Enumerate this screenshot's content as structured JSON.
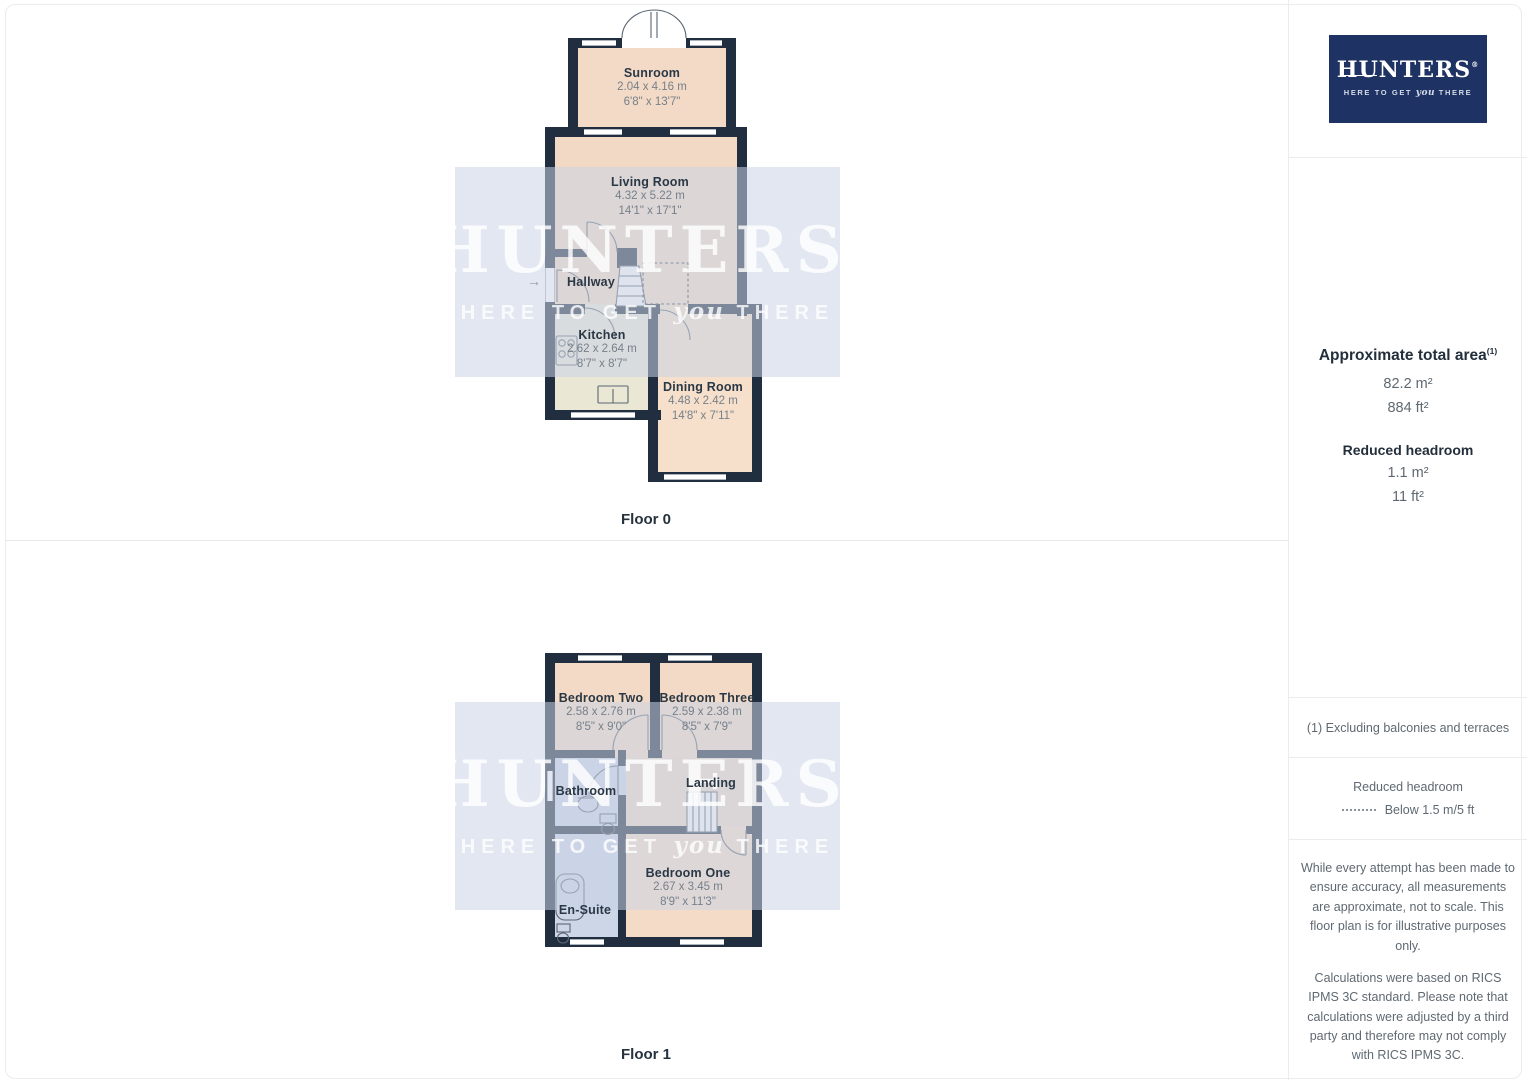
{
  "watermark": {
    "title": "HUNTERS",
    "reg": "®",
    "tagline_pre": "HERE TO GET",
    "tagline_italic": "you",
    "tagline_post": "THERE"
  },
  "floor0": {
    "label": "Floor 0",
    "entry_arrow": "→",
    "sunroom": {
      "name": "Sunroom",
      "metric": "2.04 x 4.16 m",
      "imperial": "6'8\" x 13'7\""
    },
    "living": {
      "name": "Living Room",
      "metric": "4.32 x 5.22 m",
      "imperial": "14'1\" x 17'1\""
    },
    "hallway": {
      "name": "Hallway"
    },
    "kitchen": {
      "name": "Kitchen",
      "metric": "2.62 x 2.64 m",
      "imperial": "8'7\" x 8'7\""
    },
    "dining": {
      "name": "Dining Room",
      "metric": "4.48 x 2.42 m",
      "imperial": "14'8\" x 7'11\""
    }
  },
  "floor1": {
    "label": "Floor 1",
    "bedroom2": {
      "name": "Bedroom Two",
      "metric": "2.58 x 2.76 m",
      "imperial": "8'5\" x 9'0\""
    },
    "bedroom3": {
      "name": "Bedroom Three",
      "metric": "2.59 x 2.38 m",
      "imperial": "8'5\" x 7'9\""
    },
    "bathroom": {
      "name": "Bathroom"
    },
    "landing": {
      "name": "Landing"
    },
    "ensuite": {
      "name": "En-Suite"
    },
    "bedroom1": {
      "name": "Bedroom One",
      "metric": "2.67 x 3.45 m",
      "imperial": "8'9\" x 11'3\""
    }
  },
  "sidebar": {
    "logo": {
      "title": "HUNTERS",
      "reg": "®",
      "tagline_pre": "HERE TO GET",
      "tagline_italic": "you",
      "tagline_post": "THERE"
    },
    "area": {
      "title": "Approximate total area",
      "title_sup": "(1)",
      "total_m2": "82.2 m²",
      "total_ft2": "884 ft²",
      "reduced_title": "Reduced headroom",
      "reduced_m2": "1.1 m²",
      "reduced_ft2": "11 ft²"
    },
    "footnote": "(1) Excluding balconies and terraces",
    "legend": {
      "title": "Reduced headroom",
      "item": "Below 1.5 m/5 ft"
    },
    "disclaimer_1": "While every attempt has been made to ensure accuracy, all measurements are approximate, not to scale. This floor plan is for illustrative purposes only.",
    "disclaimer_2": "Calculations were based on RICS IPMS 3C standard. Please note that calculations were adjusted by a third party and therefore may not comply with RICS IPMS 3C.",
    "brand": {
      "name_regular": "GIRAFFE",
      "name_bold": "360"
    }
  },
  "colors": {
    "wall": "#202e3f",
    "room_peach": "#f2dac6",
    "room_kitchen": "#eae7d4",
    "room_dining": "#f6e0cb",
    "room_blue": "#cdd6e6",
    "room_tan": "#eed9c7",
    "logo_navy": "#1e3263",
    "watermark_band": "#dfe3ef"
  }
}
